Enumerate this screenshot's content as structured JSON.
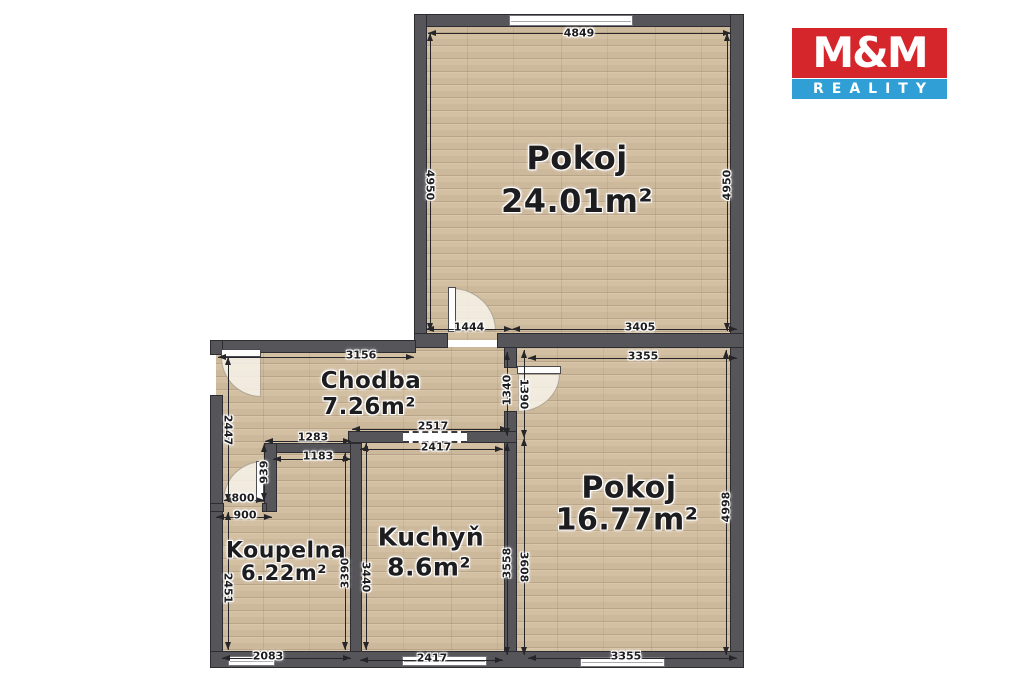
{
  "logo": {
    "title": "M&M",
    "subtitle": "REALITY",
    "red": "#d5262b",
    "blue": "#2f9fd6"
  },
  "rooms": [
    {
      "name": "Pokoj",
      "area": "24.01m²"
    },
    {
      "name": "Pokoj",
      "area": "16.77m²"
    },
    {
      "name": "Chodba",
      "area": "7.26m²"
    },
    {
      "name": "Kuchyň",
      "area": "8.6m²"
    },
    {
      "name": "Koupelna",
      "area": "6.22m²"
    }
  ],
  "dims": [
    {
      "label": "4849"
    },
    {
      "label": "4950"
    },
    {
      "label": "4950"
    },
    {
      "label": "1444"
    },
    {
      "label": "3405"
    },
    {
      "label": "3156"
    },
    {
      "label": "3355"
    },
    {
      "label": "1340"
    },
    {
      "label": "1390"
    },
    {
      "label": "2447"
    },
    {
      "label": "1283"
    },
    {
      "label": "1183"
    },
    {
      "label": "2517"
    },
    {
      "label": "2417"
    },
    {
      "label": "939"
    },
    {
      "label": "800"
    },
    {
      "label": "900"
    },
    {
      "label": "2451"
    },
    {
      "label": "3390"
    },
    {
      "label": "3440"
    },
    {
      "label": "3558"
    },
    {
      "label": "3608"
    },
    {
      "label": "4998"
    },
    {
      "label": "2083"
    },
    {
      "label": "2417"
    },
    {
      "label": "3355"
    }
  ]
}
